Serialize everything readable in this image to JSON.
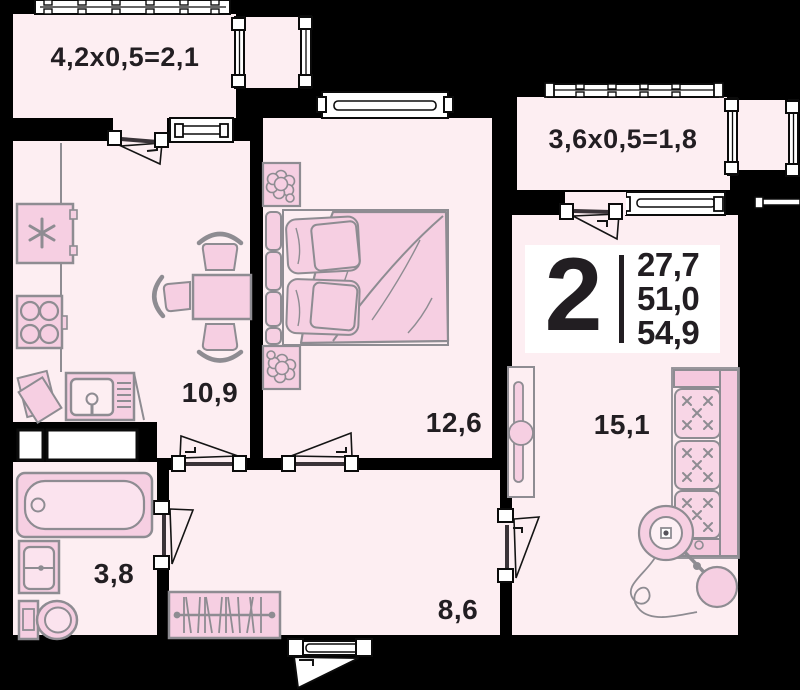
{
  "floor_plan": {
    "summary_badge": {
      "room_count": "2",
      "areas": [
        "27,7",
        "51,0",
        "54,9"
      ]
    },
    "balconies": [
      {
        "id": "balcony-top-left",
        "label": "4,2x0,5=2,1"
      },
      {
        "id": "balcony-top-right",
        "label": "3,6x0,5=1,8"
      }
    ],
    "rooms": {
      "kitchen": "10,9",
      "bedroom": "12,6",
      "living": "15,1",
      "bathroom": "3,8",
      "hallway": "8,6"
    },
    "colors": {
      "background": "#000000",
      "wall": "#000000",
      "floor": "#fdeef2",
      "furniture_fill": "#f6cfe2",
      "furniture_light": "#fbe3ee",
      "furniture_stroke": "#8e8c92",
      "window": "#ffffff",
      "text": "#221e22",
      "badge_bg": "#ffffff"
    }
  }
}
